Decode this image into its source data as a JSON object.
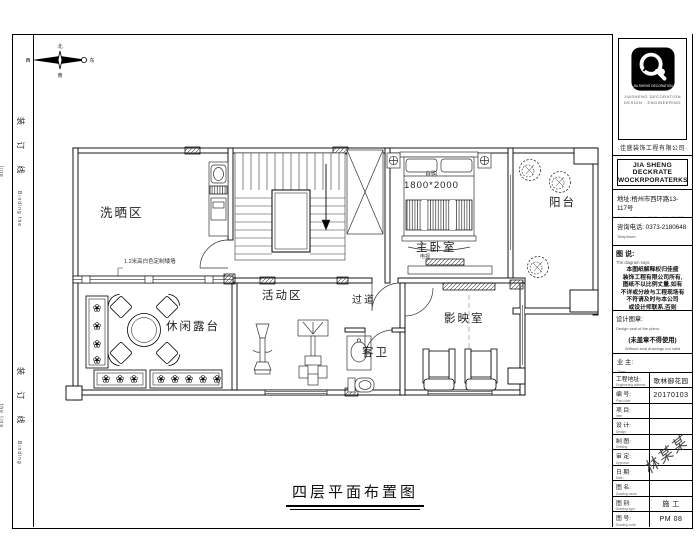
{
  "frame": {
    "binding_cn": "装 订 线",
    "binding_en": "Binding the line",
    "drawing_title": "四层平面布置图",
    "compass": {
      "n": "北",
      "s": "南",
      "w": "西",
      "e": "东"
    }
  },
  "plan": {
    "rooms": {
      "laundry": "洗晒区",
      "activity": "活动区",
      "corridor": "过道",
      "guest_bath": "客卫",
      "cinema": "影映室",
      "terrace": "休闲露台",
      "master_bedroom": "主卧室",
      "balcony": "阳台"
    },
    "annotations": {
      "bed_size": "1800*2000",
      "bed_note": "自购",
      "tv_note": "电视",
      "low_wall": "1.2米高白色定制矮墙"
    }
  },
  "titleblock": {
    "logo": {
      "emblem_label": "JIA SHENG DECORATION",
      "sub1": "JIASHENG DECORATION",
      "sub2": "DESIGN · ENGINEERING",
      "caption": "·佳盛装饰工程有限公司·"
    },
    "company_en1": "JIA SHENG DECKRATE",
    "company_en2": "WOCKRPORATERKS",
    "address_cn": "地址:梧州市西环路13-117号",
    "address_en": "Address:Wuzhou W. Road No.13-117",
    "phone_cn": "咨询电话: 0373-2180648",
    "phone_en": "Telephone:",
    "notes_label": "图 说:",
    "notes_en": "The diagram says:",
    "disclaimer": [
      "本图纸解释权归佳盛",
      "装饰工程有限公司所有,",
      "图纸不以比例丈量,如有",
      "不详或分歧与工程现场有",
      "不符请及时与本公司",
      "或设计师联系,否则",
      "将承担所有后果."
    ],
    "seal_label": "设计图章:",
    "seal_en": "Design seal of the plans:",
    "seal_note": "(未盖章不得使用)",
    "seal_note_en": "Without seal drawings not valid",
    "owner_label": "业 主:",
    "owner_en": "Own:",
    "rows": [
      {
        "label": "工程地址:",
        "en": "Engineering address:",
        "value": "歌林御花园"
      },
      {
        "label": "编 号:",
        "en": "Plan code:",
        "value": "20170103"
      },
      {
        "label": "项 目:",
        "en": "Item:",
        "value": ""
      },
      {
        "label": "设 计:",
        "en": "Design:",
        "value": ""
      },
      {
        "label": "制 图:",
        "en": "Drafting:",
        "value": ""
      },
      {
        "label": "审 定:",
        "en": "Approval:",
        "value": ""
      },
      {
        "label": "日 期:",
        "en": "Date:",
        "value": ""
      },
      {
        "label": "图 名:",
        "en": "Drawing name:",
        "value": ""
      },
      {
        "label": "图 别:",
        "en": "Drawing type:",
        "value": "施 工"
      },
      {
        "label": "图 号:",
        "en": "Drawing code:",
        "value": "PM 08"
      }
    ],
    "signature": "林某某"
  }
}
